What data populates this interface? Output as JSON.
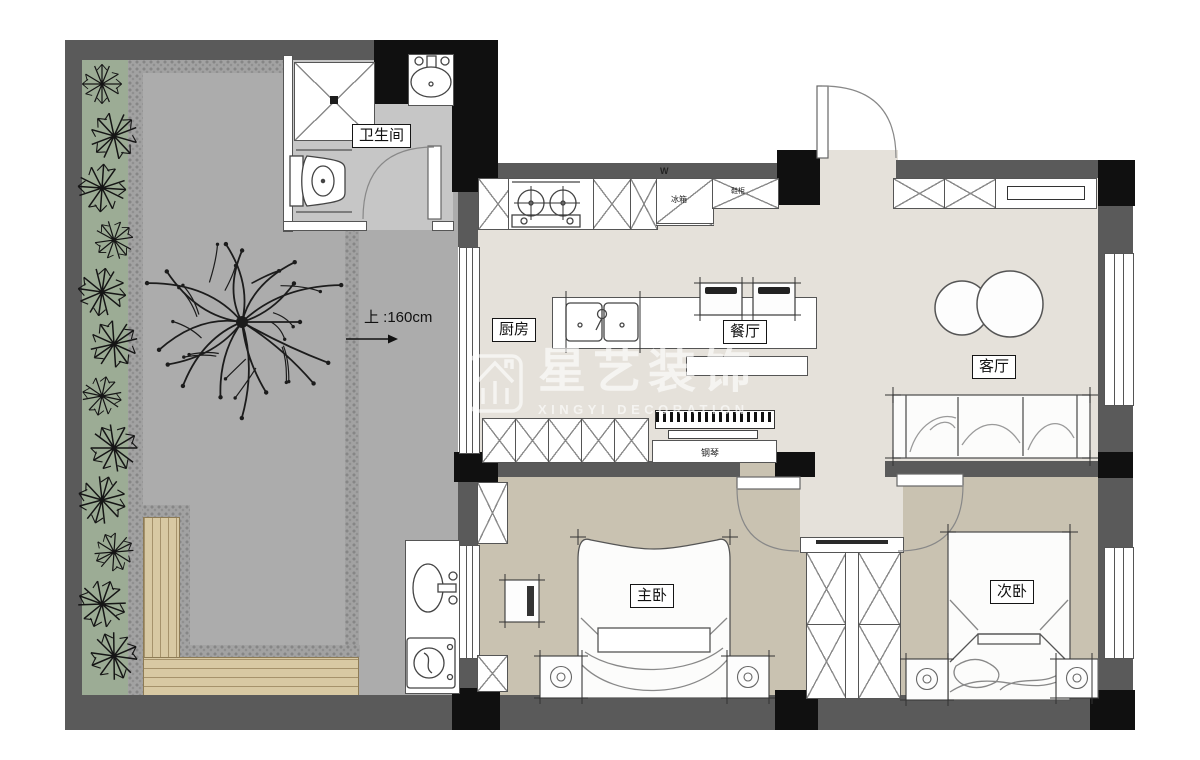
{
  "rooms": {
    "bathroom": "卫生间",
    "kitchen": "厨房",
    "dining": "餐厅",
    "living": "客厅",
    "master_bedroom": "主卧",
    "second_bedroom": "次卧"
  },
  "fixtures": {
    "fridge": "冰箱",
    "shoe_cabinet": "鞋柜",
    "piano": "钢琴",
    "fridge_mark": "W"
  },
  "annotations": {
    "stair_note": "上 :160cm"
  },
  "watermark": {
    "brand": "星艺装饰",
    "subtitle": "XINGYI DECORATION"
  },
  "colors": {
    "wall": "#5a5a5a",
    "column": "#101010",
    "floor_main": "#e5e1da",
    "floor_bedroom": "#c9c2b1",
    "floor_bathroom": "#c6c6c6",
    "courtyard": "#acacac",
    "planting": "#9cac95",
    "deck": "#d8c9a3",
    "line": "#555555"
  }
}
